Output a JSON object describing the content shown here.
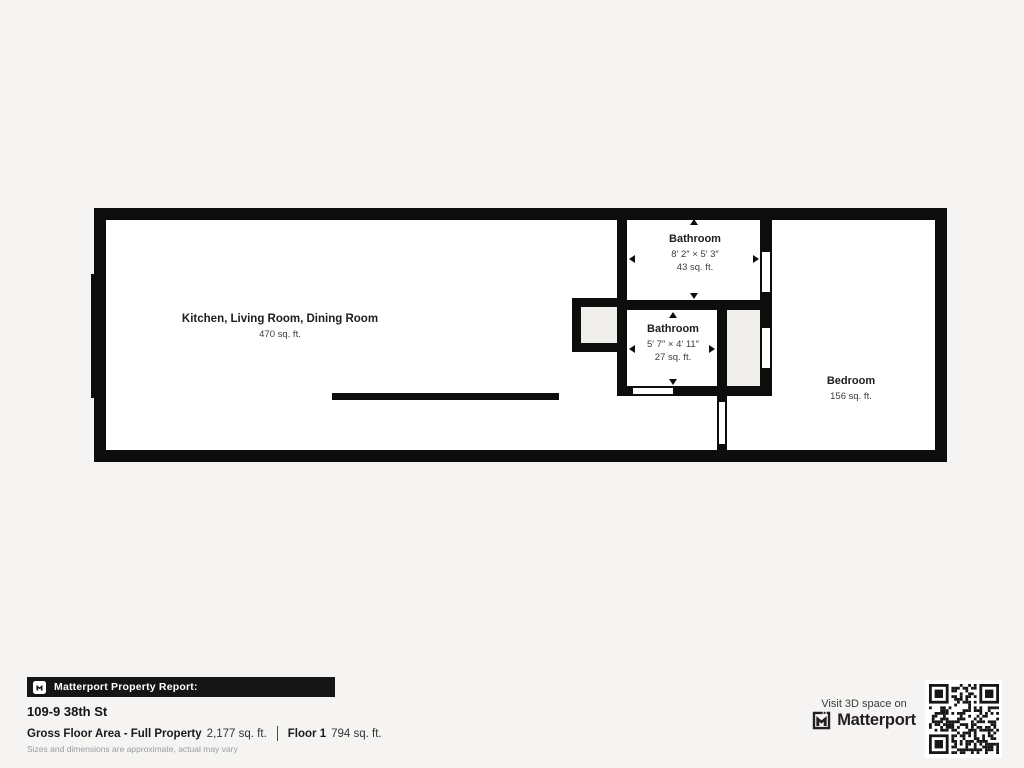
{
  "colors": {
    "background": "#f5f4f2",
    "wall": "#0d0d0d",
    "floor": "#ffffff",
    "closet_fill": "#efeeeb",
    "banner_bg": "#151515",
    "text_primary": "#1c1c1c",
    "text_secondary": "#3d3d3d",
    "muted": "#9b9b9b",
    "brand": "#221f20"
  },
  "plan": {
    "rooms": {
      "main": {
        "name": "Kitchen, Living Room, Dining Room",
        "area": "470 sq. ft."
      },
      "bathroom_top": {
        "name": "Bathroom",
        "dims": "8′ 2″ × 5′ 3″",
        "area": "43 sq. ft."
      },
      "bathroom_mid": {
        "name": "Bathroom",
        "dims": "5′ 7″ × 4′ 11″",
        "area": "27 sq. ft."
      },
      "bedroom": {
        "name": "Bedroom",
        "area": "156 sq. ft."
      }
    }
  },
  "report": {
    "bar_label": "Matterport Property Report:",
    "address": "109-9 38th St",
    "gross_label": "Gross Floor Area - Full Property",
    "gross_value": "2,177 sq. ft.",
    "floor_label": "Floor 1",
    "floor_value": "794 sq. ft.",
    "disclaimer": "Sizes and dimensions are approximate, actual may vary"
  },
  "cta": {
    "visit_text": "Visit 3D space on",
    "brand": "Matterport",
    "qr_icon": "qr-code"
  }
}
